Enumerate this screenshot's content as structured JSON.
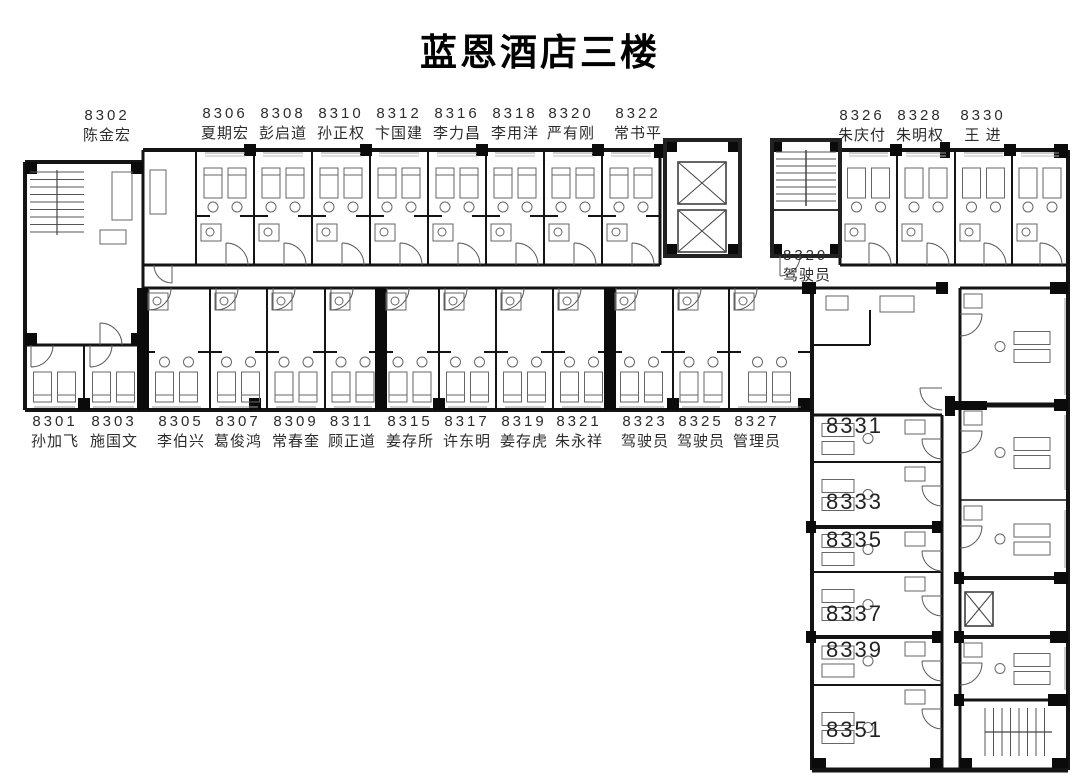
{
  "title": "蓝恩酒店三楼",
  "colors": {
    "wall": "#141414",
    "label": "#2d2d2d",
    "furniture": "#666666",
    "background": "#ffffff"
  },
  "rooms": [
    {
      "num": "8302",
      "name": "陈金宏"
    },
    {
      "num": "8306",
      "name": "夏期宏"
    },
    {
      "num": "8308",
      "name": "彭启道"
    },
    {
      "num": "8310",
      "name": "孙正权"
    },
    {
      "num": "8312",
      "name": "卞国建"
    },
    {
      "num": "8316",
      "name": "李力昌"
    },
    {
      "num": "8318",
      "name": "李用洋"
    },
    {
      "num": "8320",
      "name": "严有刚"
    },
    {
      "num": "8322",
      "name": "常书平"
    },
    {
      "num": "8326",
      "name": "朱庆付"
    },
    {
      "num": "8328",
      "name": "朱明权"
    },
    {
      "num": "8330",
      "name": "王 进"
    },
    {
      "num": "8329",
      "name": "驾驶员"
    },
    {
      "num": "8301",
      "name": "孙加飞"
    },
    {
      "num": "8303",
      "name": "施国文"
    },
    {
      "num": "8305",
      "name": "李伯兴"
    },
    {
      "num": "8307",
      "name": "葛俊鸿"
    },
    {
      "num": "8309",
      "name": "常春奎"
    },
    {
      "num": "8311",
      "name": "顾正道"
    },
    {
      "num": "8315",
      "name": "姜存所"
    },
    {
      "num": "8317",
      "name": "许东明"
    },
    {
      "num": "8319",
      "name": "姜存虎"
    },
    {
      "num": "8321",
      "name": "朱永祥"
    },
    {
      "num": "8323",
      "name": "驾驶员"
    },
    {
      "num": "8325",
      "name": "驾驶员"
    },
    {
      "num": "8327",
      "name": "管理员"
    },
    {
      "num": "8331",
      "name": ""
    },
    {
      "num": "8333",
      "name": ""
    },
    {
      "num": "8335",
      "name": ""
    },
    {
      "num": "8337",
      "name": ""
    },
    {
      "num": "8339",
      "name": ""
    },
    {
      "num": "8351",
      "name": ""
    }
  ]
}
